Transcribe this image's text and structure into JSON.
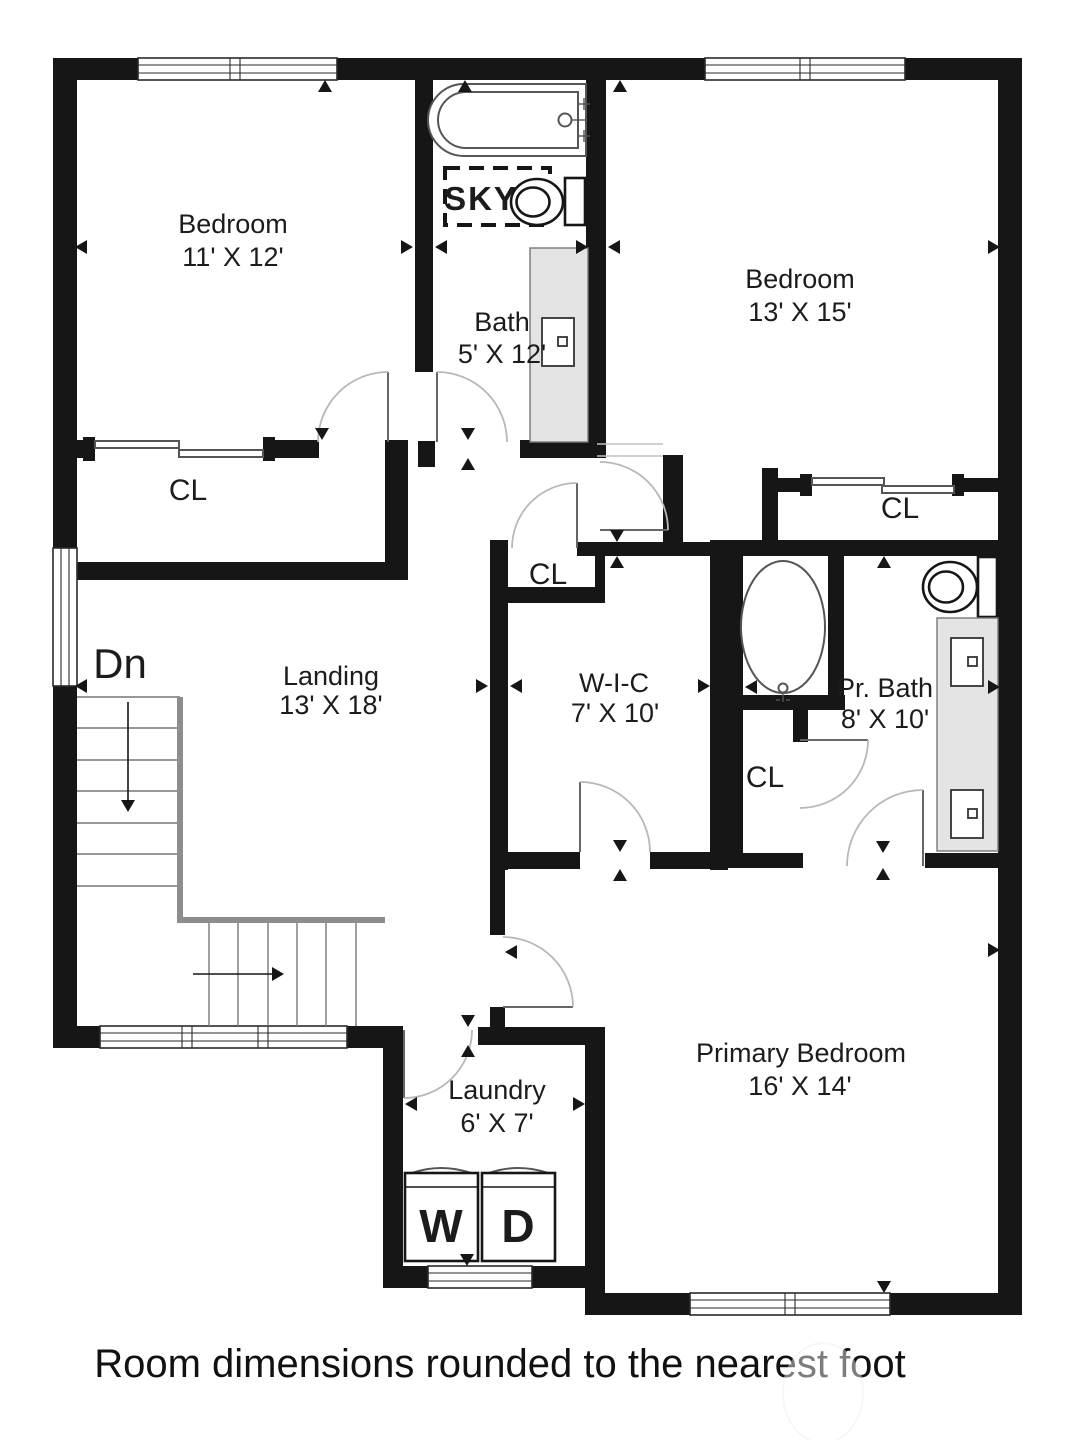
{
  "plan": {
    "title": "Upper floor plan",
    "rooms": {
      "bedroom1": {
        "name": "Bedroom",
        "dims": "11' X 12'"
      },
      "bath": {
        "name": "Bath",
        "dims": "5' X 12'"
      },
      "bedroom2": {
        "name": "Bedroom",
        "dims": "13' X 15'"
      },
      "landing": {
        "name": "Landing",
        "dims": "13' X 18'"
      },
      "wic": {
        "name": "W-I-C",
        "dims": "7' X 10'"
      },
      "pr_bath": {
        "name": "Pr. Bath",
        "dims": "8' X 10'"
      },
      "primary_bedroom": {
        "name": "Primary Bedroom",
        "dims": "16' X 14'"
      },
      "laundry": {
        "name": "Laundry",
        "dims": "6' X 7'"
      }
    },
    "labels": {
      "closet": "CL",
      "stairs_down": "Dn",
      "skylight": "SKY",
      "washer": "W",
      "dryer": "D"
    },
    "footer": {
      "note": "Room dimensions rounded to the nearest foot"
    },
    "colors": {
      "wall": "#161616",
      "vanity_fill": "#e4e4e4",
      "stair_stringer": "#8d8d8d",
      "text": "#1c1c1c",
      "background": "#ffffff"
    }
  }
}
